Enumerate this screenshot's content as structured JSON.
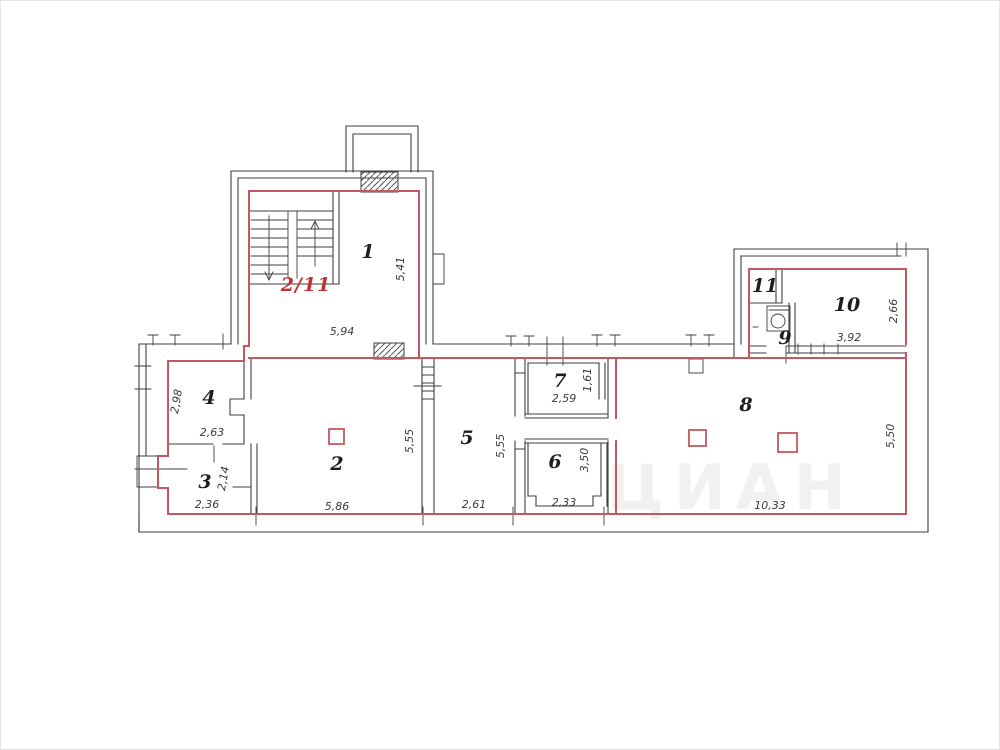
{
  "plan": {
    "unit_label": "2/11",
    "watermark": "ЦИАН",
    "rooms": {
      "room1": "1",
      "room2": "2",
      "room3": "3",
      "room4": "4",
      "room5": "5",
      "room6": "6",
      "room7": "7",
      "room8": "8",
      "room9": "9",
      "room10": "10",
      "room11": "11"
    },
    "dimensions": {
      "room1_height": "5,41",
      "room1_width": "5,94",
      "room4_height": "2,98",
      "room4_width": "2,63",
      "room3_height": "2,14",
      "room3_width": "2,36",
      "room2_width": "5,86",
      "room2_height": "5,55",
      "room5_width": "2,61",
      "room5_height": "5,55",
      "room7_width": "2,59",
      "room7_height": "1,61",
      "room6_width": "2,33",
      "room6_height": "3,50",
      "room10_width": "3,92",
      "room10_height": "2,66",
      "room8_width": "10,33",
      "room8_height": "5,50"
    },
    "colors": {
      "wall_black": "#3f3f3f",
      "boundary_red": "#c2595e",
      "accent_red": "#c03238",
      "dim_text": "#3a3a3a"
    }
  }
}
